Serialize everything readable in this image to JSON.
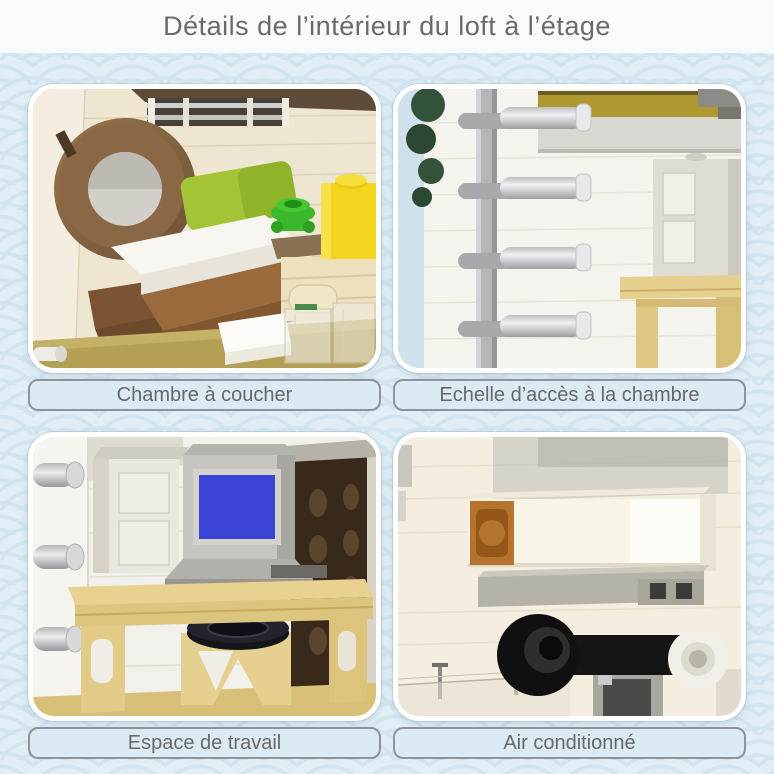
{
  "title": "Détails de l’intérieur du loft à l’étage",
  "panels": [
    {
      "id": "bedroom",
      "caption": "Chambre à coucher",
      "photo_description": "Brick-built bedroom: round brown mirror ring, bed with white mattress and lime-green headboard on brown base, yellow brick, green flower piece, cream drawers, clear transparent bricks, olive floor"
    },
    {
      "id": "ladder",
      "caption": "Echelle d’accès à la chambre",
      "photo_description": "Grey vertical rail with four silver cylinder rungs on a white brick wall, dark green foliage and sky at left, gold ledge and white cabinet with tan desk at right"
    },
    {
      "id": "workspace",
      "caption": "Espace de travail",
      "photo_description": "Tan desk with silver CRT monitor showing a blue screen, white cabinet, tan stool with round black seat, grey wall studs at left, dark brown interior wall at right"
    },
    {
      "id": "air-conditioning",
      "caption": "Air conditionné",
      "photo_description": "White air-conditioning unit with amber brick on a cream brick wall, grey vent shelf with two dark squares, black fan drum and bar with white cylinder, glass railing below"
    }
  ],
  "colors": {
    "page_background": "#e1eef5",
    "pattern_arc": "#d2e5ef",
    "header_background": "#f8fbfc",
    "title_text": "#6a6a6a",
    "caption_background": "#dcebf3",
    "caption_border": "#8d9398",
    "caption_text": "#67686a",
    "panel_border": "#ffffff",
    "bedroom_green": "#a3c437",
    "bedroom_yellow": "#f3d41e",
    "bedroom_brown": "#81603f",
    "ladder_silver": "#d6d6d8",
    "monitor_screen_blue": "#3b46d6",
    "stool_seat_black": "#15151a",
    "ac_amber": "#b5732d",
    "fan_black": "#101010"
  }
}
